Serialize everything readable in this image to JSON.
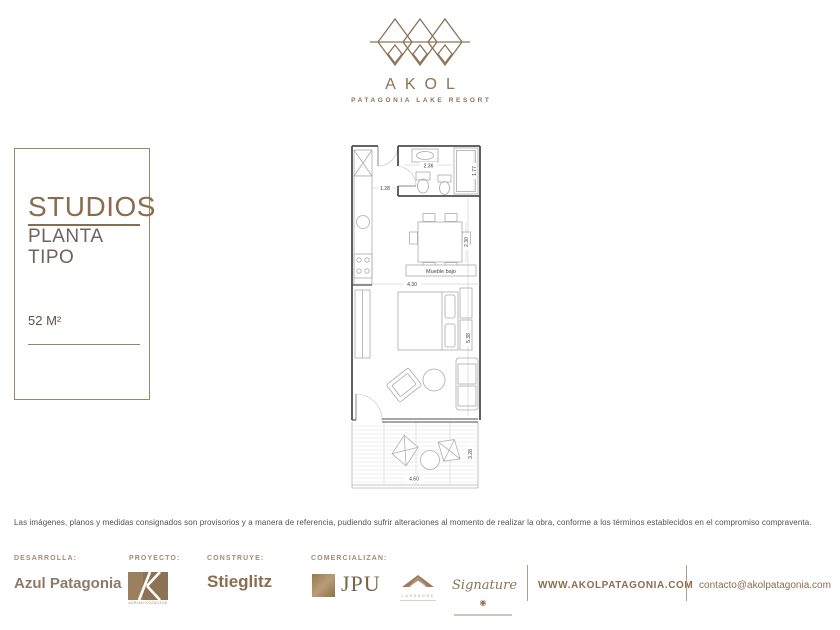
{
  "brand": {
    "name": "AKOL",
    "tagline": "PATAGONIA LAKE RESORT"
  },
  "panel": {
    "title": "STUDIOS",
    "subtitle": "PLANTA TIPO",
    "area": "52 M²"
  },
  "plan": {
    "mueble_bajo": "Mueble bajo",
    "dims": {
      "bath_w": "2.36",
      "bath_d": "1.77",
      "hall": "1.28",
      "dining": "2.30",
      "width": "4.30",
      "depth": "5.38",
      "deck_w": "4.60",
      "deck_d": "3.28"
    }
  },
  "disclaimer": "Las imágenes, planos y medidas consignados son provisorios y a manera de referencia, pudiendo sufrir alteraciones al momento de realizar la obra, conforme a los términos establecidos en el compromiso compraventa.",
  "footer": {
    "developer_label": "DESARROLLA:",
    "developer": "Azul Patagonia",
    "project_label": "PROYECTO:",
    "project_caption": "ADRIAN KOZACZUK",
    "builder_label": "CONSTRUYE:",
    "builder": "Stieglitz",
    "commercial_label": "COMERCIALIZAN:",
    "jpu": "JPU",
    "cassagne": "CASSAGNE",
    "signature": "Signature",
    "website": "WWW.AKOLPATAGONIA.COM",
    "email": "contacto@akolpatagonia.com"
  },
  "colors": {
    "brand": "#8a6e50",
    "logo": "#8d7357"
  }
}
